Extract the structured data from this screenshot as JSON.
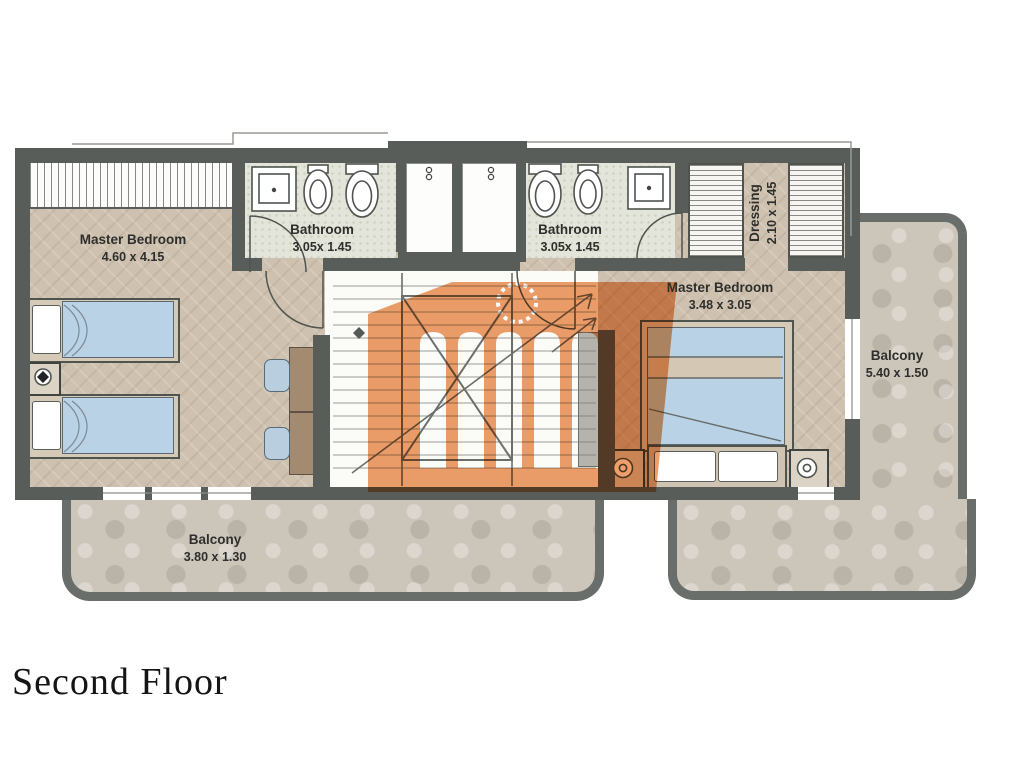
{
  "caption": "Second Floor",
  "rooms": {
    "master_bedroom_left": {
      "name": "Master Bedroom",
      "dims": "4.60 x 4.15"
    },
    "bathroom_left": {
      "name": "Bathroom",
      "dims": "3.05x 1.45"
    },
    "bathroom_right": {
      "name": "Bathroom",
      "dims": "3.05x 1.45"
    },
    "dressing": {
      "name": "Dressing",
      "dims": "2.10 x 1.45"
    },
    "master_bedroom_right": {
      "name": "Master Bedroom",
      "dims": "3.48 x 3.05"
    },
    "balcony_right": {
      "name": "Balcony",
      "dims": "5.40 x 1.50"
    },
    "balcony_bottom": {
      "name": "Balcony",
      "dims": "3.80 x 1.30"
    }
  },
  "colors": {
    "wall": "#585d5a",
    "balcony_wall": "#6a6e6a",
    "bedroom_floor": "#cfc1b0",
    "bathroom_floor": "#e4e5da",
    "stone_floor": "#ccc5ba",
    "bed_blue": "#b9d2e6",
    "furniture_brown": "#a28b70",
    "watermark_orange": "#ee9a63",
    "label_text": "#2e2e2c"
  }
}
